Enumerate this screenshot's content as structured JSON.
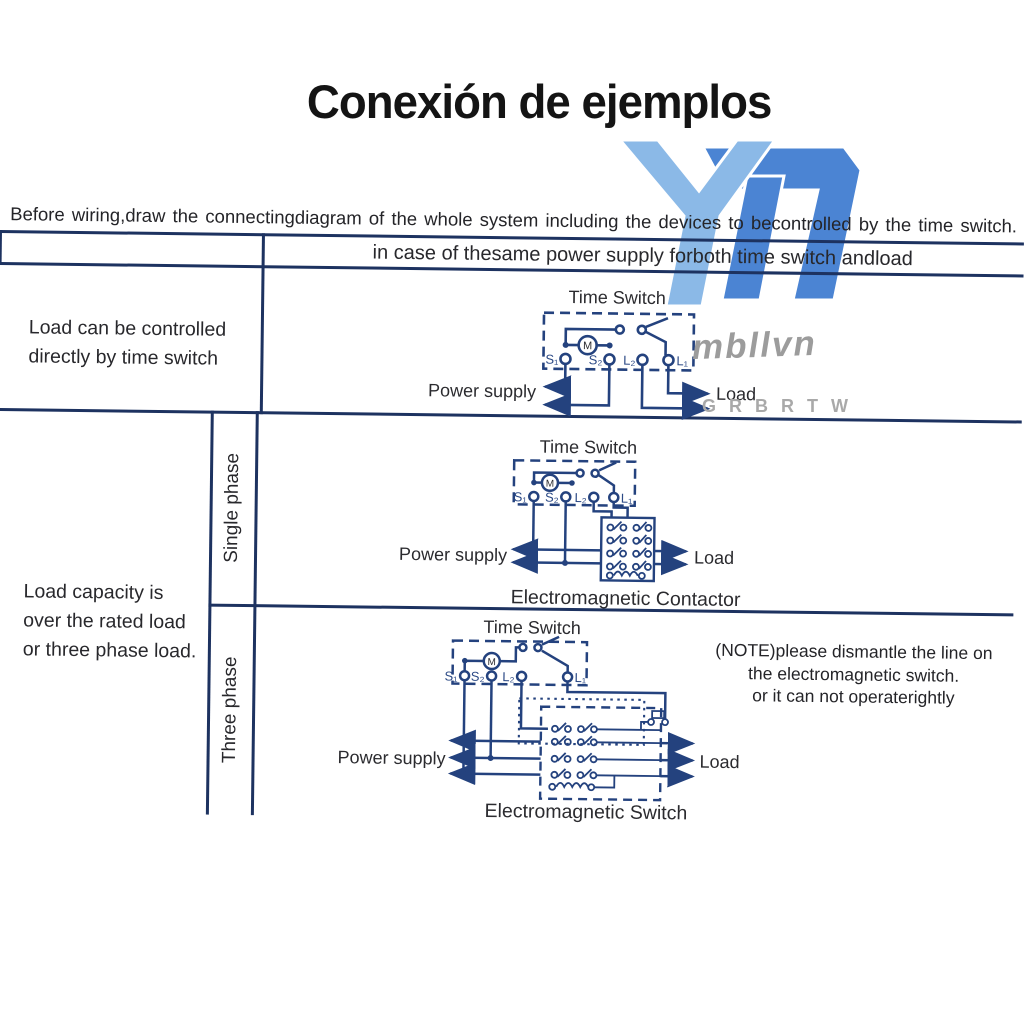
{
  "title": "Conexión de ejemplos",
  "intro": "Before wiring,draw the connectingdiagram of the whole system including the devices to becontrolled by the time switch.",
  "table": {
    "header": "in case of thesame power supply forboth time switch andload",
    "row1_label": [
      "Load can be controlled",
      "directly by time switch"
    ],
    "row2_label": [
      "Load capacity is",
      "over the rated load",
      "or three phase load."
    ],
    "phase_labels": {
      "single": "Single phase",
      "three": "Three phase"
    }
  },
  "terminals": {
    "s1": "S₁",
    "s2": "S₂",
    "l2": "L₂",
    "l1": "L₁",
    "motor": "M"
  },
  "diagram1": {
    "title": "Time Switch",
    "power": "Power supply",
    "load": "Load"
  },
  "diagram2": {
    "title": "Time Switch",
    "power": "Power supply",
    "load": "Load",
    "caption": "Electromagnetic Contactor"
  },
  "diagram3": {
    "title": "Time Switch",
    "power": "Power supply",
    "load": "Load",
    "caption": "Electromagnetic Switch",
    "note": [
      "(NOTE)please dismantle the line on",
      "the electromagnetic switch.",
      "or it can not operaterightly"
    ]
  },
  "watermark": {
    "name": "mbllvn",
    "letters": "G R B R T W",
    "colors": {
      "y": "#8bb9e7",
      "d": "#4b84d3",
      "line": "#1d3260",
      "wire": "#24427e"
    }
  }
}
